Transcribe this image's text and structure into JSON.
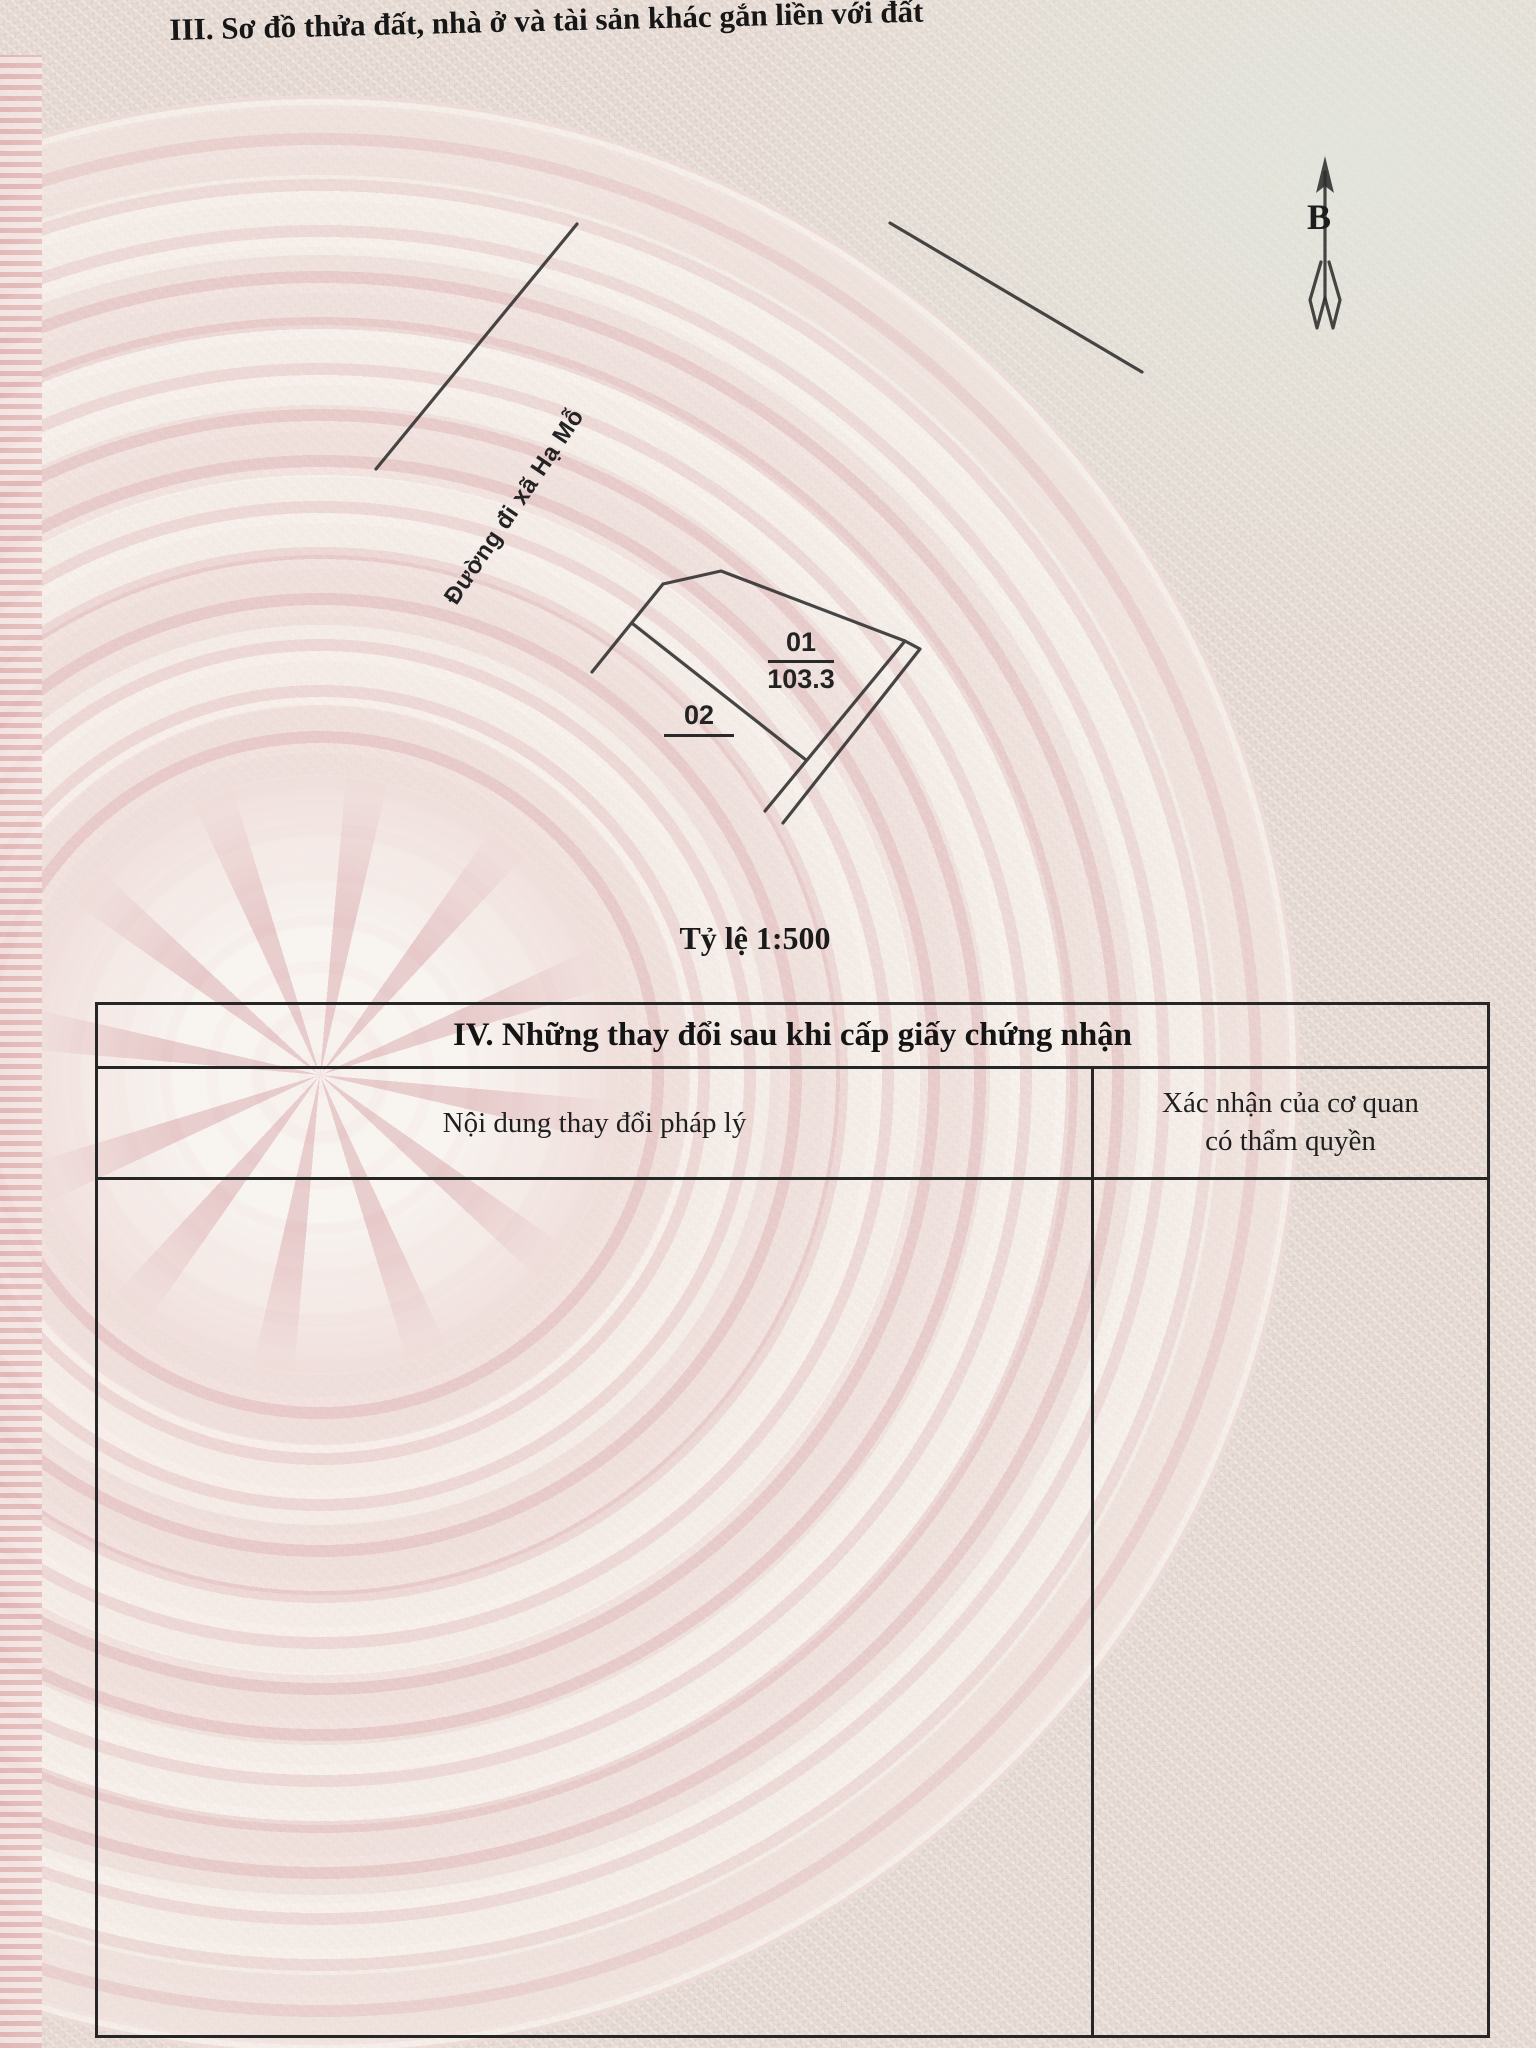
{
  "document": {
    "section3_title": "III. Sơ đồ thửa đất, nhà ở và tài sản khác gắn liền với đất",
    "scale_label": "Tỷ lệ 1:500"
  },
  "sketch_map": {
    "road_label": "Đường đi xã Hạ Mỗ",
    "north_arrow_label": "B",
    "parcels": [
      {
        "number": "01",
        "area": "103.3"
      },
      {
        "number": "02",
        "area": ""
      }
    ]
  },
  "section4_table": {
    "title": "IV. Những thay đổi sau khi cấp giấy chứng nhận",
    "col1_header": "Nội dung thay đổi pháp lý",
    "col2_header_line1": "Xác nhận của cơ quan",
    "col2_header_line2": "có thẩm quyền",
    "rows": []
  },
  "colors": {
    "paper_pink": "#ecd6d4",
    "paper_light": "#e9e6dd",
    "ink": "#1f1f1f",
    "line": "#2e2e2e"
  }
}
